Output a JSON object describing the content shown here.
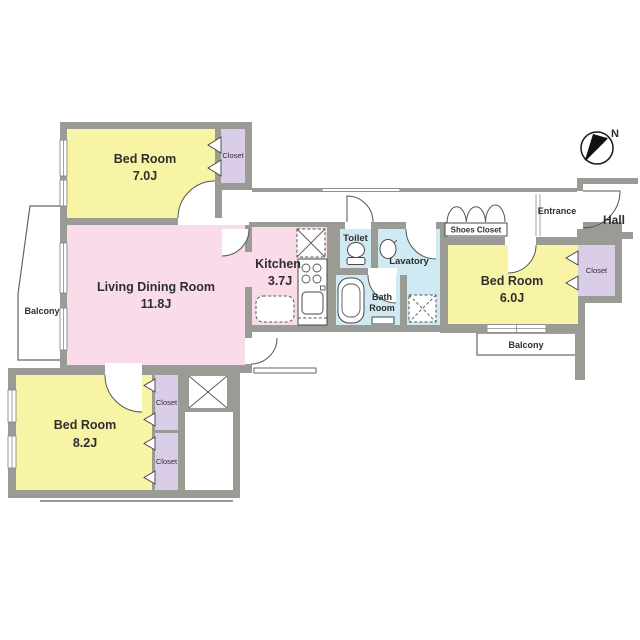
{
  "plan": {
    "type": "apartment-floor-plan",
    "rooms": {
      "bedroom_7": {
        "name": "Bed Room",
        "size": "7.0J"
      },
      "living": {
        "name": "Living Dining Room",
        "size": "11.8J"
      },
      "kitchen": {
        "name": "Kitchen",
        "size": "3.7J"
      },
      "bedroom_6": {
        "name": "Bed Room",
        "size": "6.0J"
      },
      "bedroom_8": {
        "name": "Bed Room",
        "size": "8.2J"
      },
      "toilet": {
        "name": "Toilet"
      },
      "lavatory": {
        "name": "Lavatory"
      },
      "bath": {
        "name_line1": "Bath",
        "name_line2": "Room"
      },
      "entrance": {
        "name": "Entrance"
      },
      "hall": {
        "name": "Hall"
      },
      "shoes_closet": {
        "name": "Shoes Closet"
      },
      "balcony_left": {
        "name": "Balcony"
      },
      "balcony_right": {
        "name": "Balcony"
      }
    },
    "closets": {
      "bedroom7_closet": "Closet",
      "bedroom6_closet": "Closet",
      "bedroom8_closet_top": "Closet",
      "bedroom8_closet_bottom": "Closet"
    },
    "compass": {
      "north_label": "N",
      "direction": "north-east"
    },
    "colors": {
      "wall": "#9b9b96",
      "bedroom_fill": "#f8f4a6",
      "living_fill": "#fadbe9",
      "wet_area_fill": "#cfeaf3",
      "closet_fill": "#d9cde8",
      "outline": "#555555",
      "background": "#ffffff"
    }
  }
}
